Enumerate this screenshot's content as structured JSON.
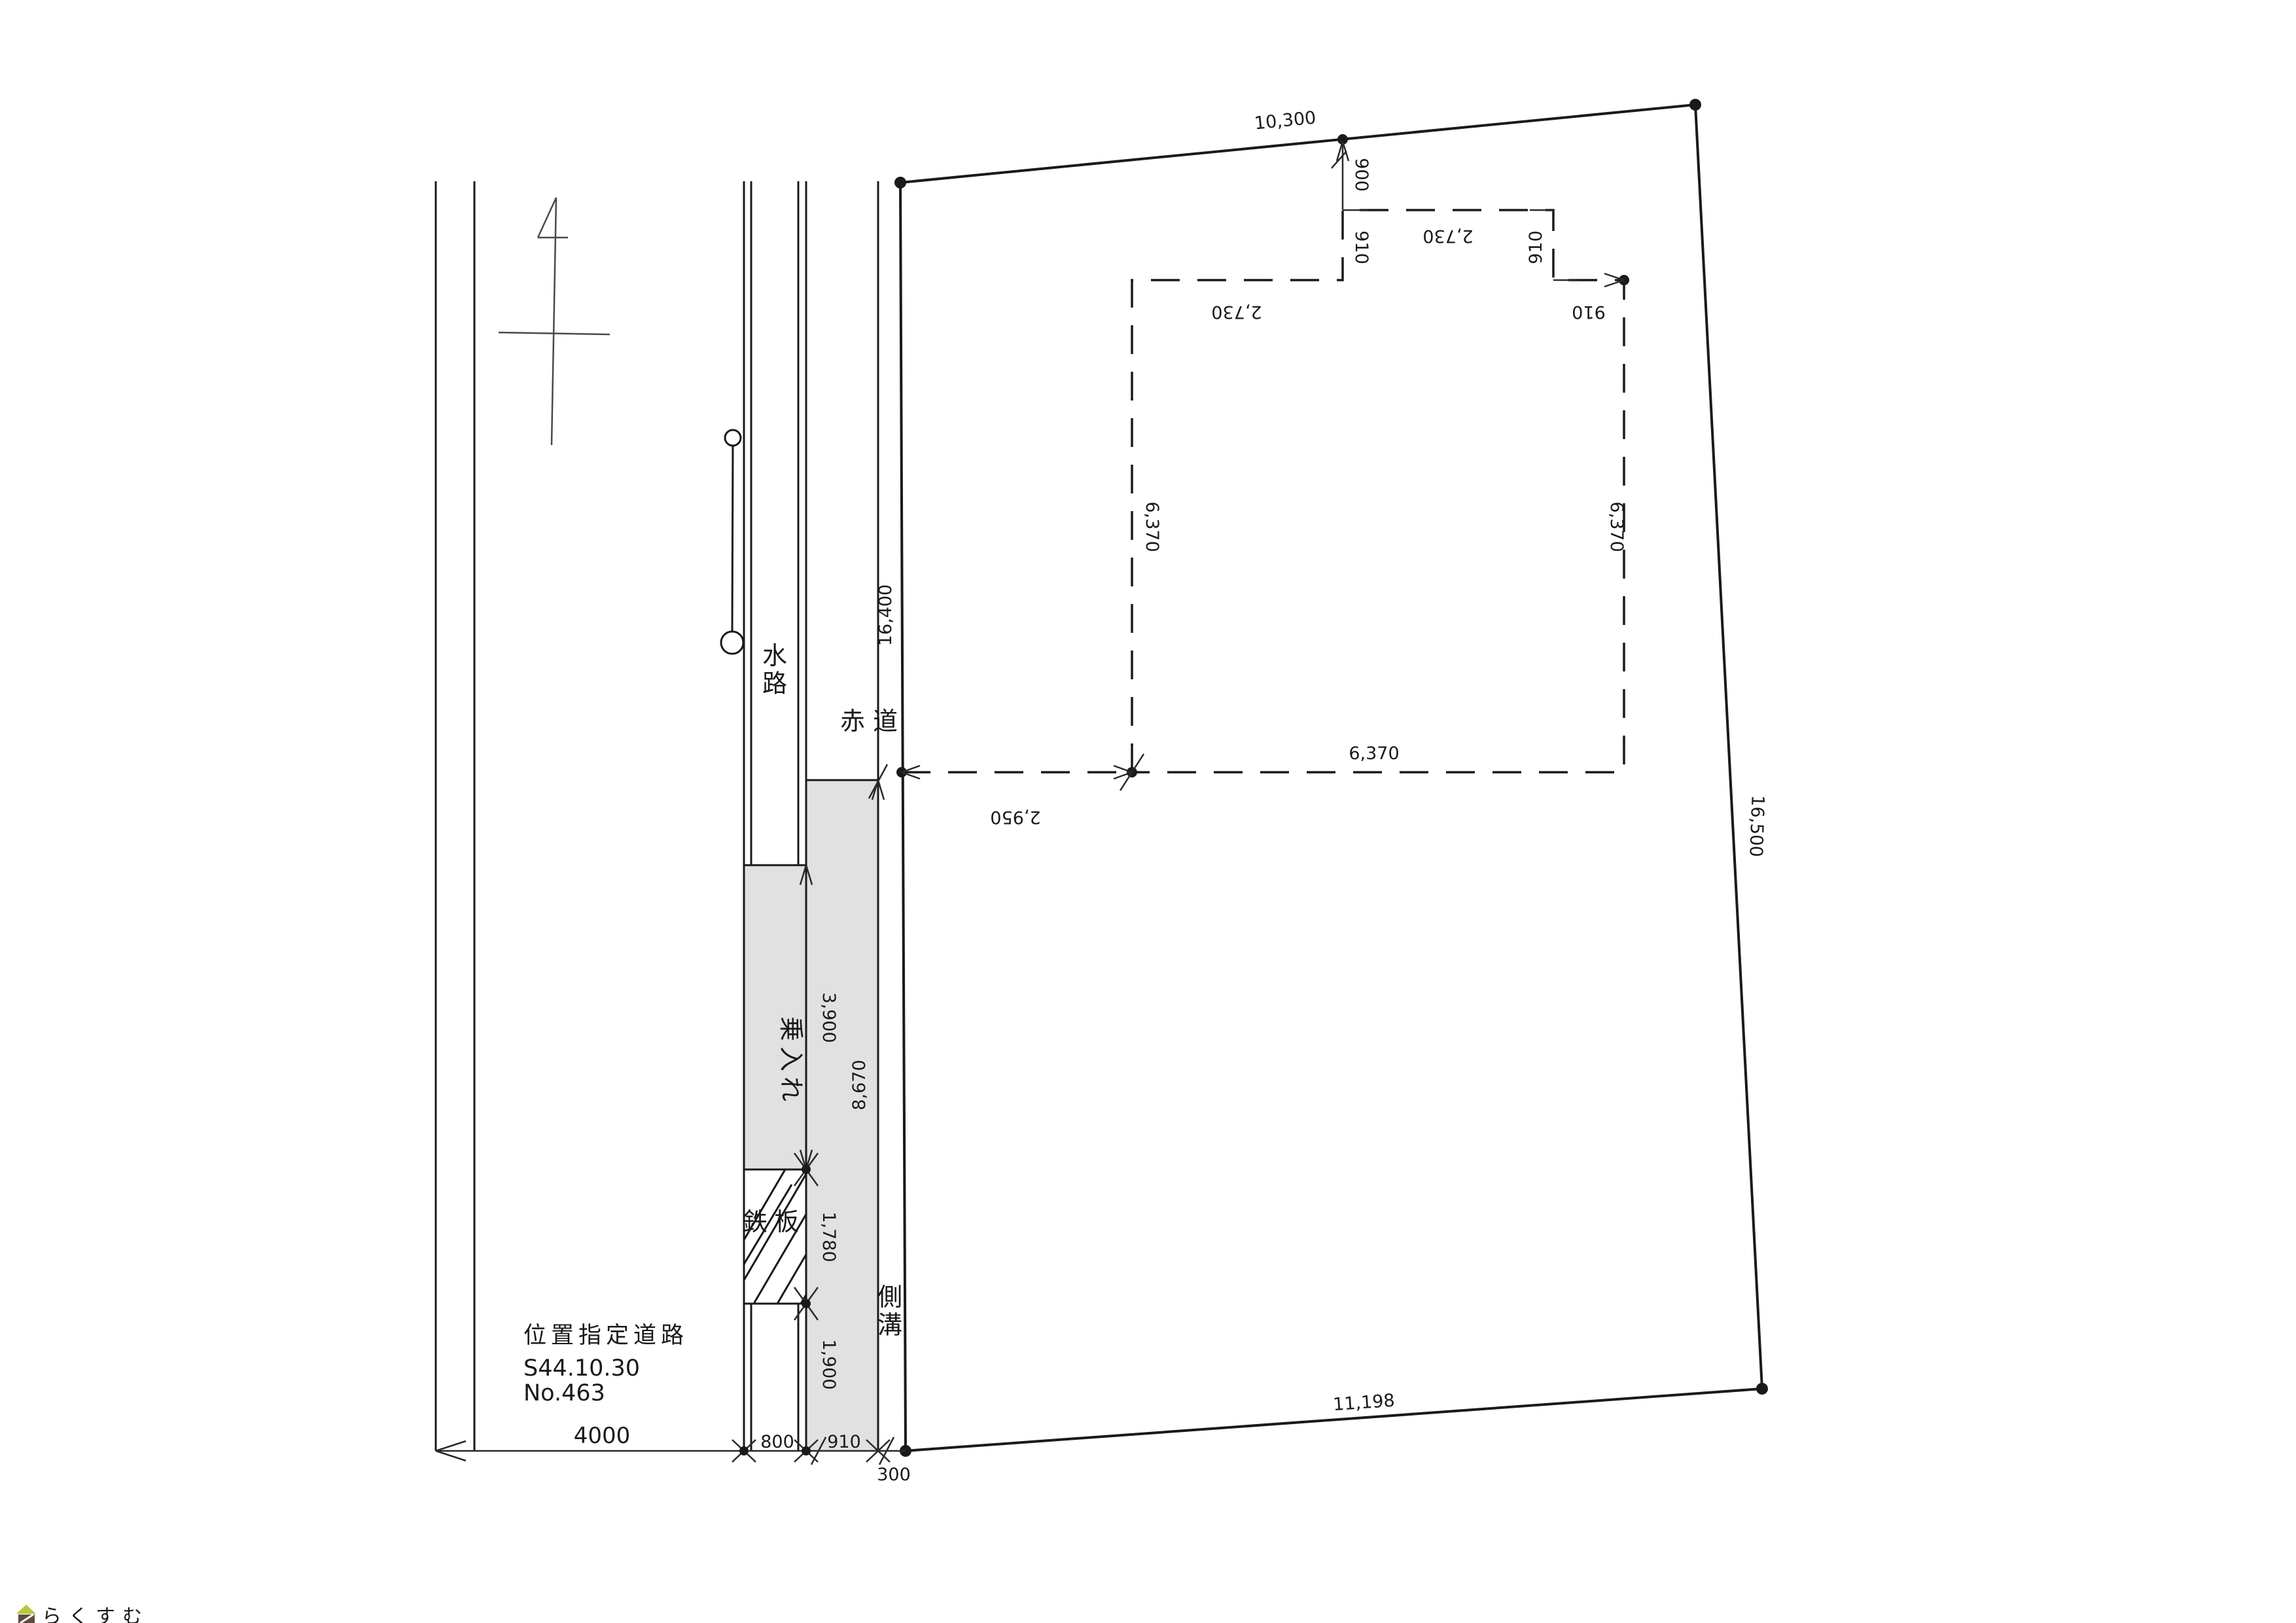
{
  "drawing_type": "site-plan",
  "colors": {
    "ink": "#1a1a1a",
    "thin_ink": "#2a2a2a",
    "north_ink": "#4a4a4a",
    "gray_fill": "#e1e1e1",
    "watermark_roof": "#b4c83e",
    "watermark_body": "#5f4b3f",
    "watermark_text": "#8b7b72"
  },
  "dims": {
    "top_width": "10,300",
    "left_height": "16,400",
    "right_height": "16,500",
    "bottom_width": "11,198",
    "road_width": "4000",
    "waterway_width": "800",
    "gutter_width": "910",
    "ditch_width": "300",
    "offset_900": "900",
    "module_910": "910",
    "span_2730": "2,730",
    "building_6370": "6,370",
    "offset_2950": "2,950",
    "driveway_3900": "3,900",
    "gutter_len_8670": "8,670",
    "plate_1780": "1,780",
    "below_plate_1900": "1,900"
  },
  "labels": {
    "waterway": "水路",
    "red_road": "赤道",
    "driveway": "乗入れ",
    "steel_plate": "鉄板",
    "side_gutter": "側溝",
    "road_note_line1": "位置指定道路",
    "road_note_line2": "S44.10.30",
    "road_note_line3": "No.463"
  },
  "watermark": {
    "text": "らくすむ",
    "icon": "house-icon"
  }
}
